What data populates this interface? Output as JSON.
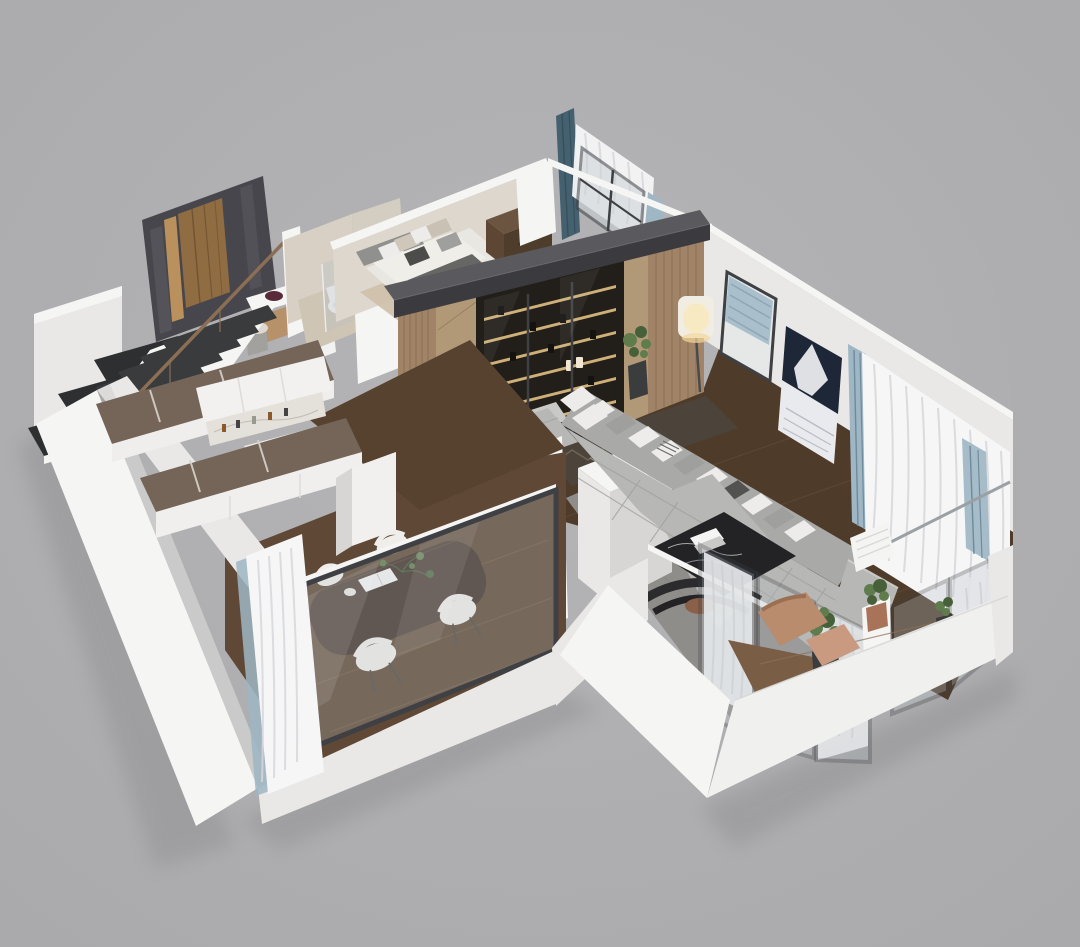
{
  "scene": {
    "label": "Isometric 3D cutaway render of a modern apartment floor plan on a gray background",
    "type": "architectural-visualization",
    "background": "#b5b5b7"
  },
  "rooms": [
    {
      "id": "entry-stairs",
      "label": "Entry hall with dark staircase, glossy wardrobe panel and bronze handrail"
    },
    {
      "id": "bathroom",
      "label": "Bathroom with toilet and glass shower partition"
    },
    {
      "id": "bedroom",
      "label": "Bedroom with upholstered bed, pillows and dark wood dresser"
    },
    {
      "id": "kitchen",
      "label": "U-shaped kitchen with smoked-oak counters, white fronts and marble island"
    },
    {
      "id": "dining-room",
      "label": "Dining room with dark wood table and four white chairs behind glazed wall"
    },
    {
      "id": "living-room",
      "label": "Living room with gray tufted corner sofa, marble coffee table and lit media wall"
    },
    {
      "id": "balcony-terrace",
      "label": "Glazed balcony terrace with plants, lounge chair and sheer curtains"
    }
  ],
  "palette": {
    "bg": "#b5b5b7",
    "bgEdge": "#aaaaac",
    "shadow": "#8e8e91",
    "wallWhite": "#f5f5f4",
    "wallLight": "#e9e8e6",
    "wallMid": "#d7d6d4",
    "wallShade": "#c7c6c4",
    "seam": "#dddcda",
    "beigeWall": "#d8d0c4",
    "beigeLite": "#ded7cd",
    "beigeFloor": "#cec0a9",
    "floorDark": "#4f3b2a",
    "floorStreak": "#66503a",
    "floorMid": "#5f4936",
    "floorMidStreak": "#7a624a",
    "balcWood": "#7a5d45",
    "balcStreak": "#8d7057",
    "counter": "#756559",
    "counterSeam": "#d8d3cb",
    "marble": "#e4e0da",
    "marbleVein": "#b9b5ae",
    "slabTop": "#5a5a5e",
    "slabFront": "#3b3b3f",
    "gloss": "#47464c",
    "glossHi": "#5d5c63",
    "doorWood": "#8f6c42",
    "doorGold": "#ba915c",
    "doorGrain": "#6b4e2e",
    "stairTread": "#3a3b3d",
    "stairDark": "#2e2f31",
    "rail": "#8c6e54",
    "slat": "#a18467",
    "slatDark": "#826a4e",
    "chevron": "#b19877",
    "shelfDark": "#221e19",
    "shelfGlow": "#ecca8a",
    "book1": "#d9d2c2",
    "book2": "#776753",
    "book3": "#3e3a34",
    "sofa": "#b7b7b5",
    "sofaDk": "#a9a9a7",
    "pilW": "#edecea",
    "pilG": "#9f9f9d",
    "pilD": "#525250",
    "rugGray": "#8f8d8a",
    "rugDark": "#4c443a",
    "rugZig": "#8a7a64",
    "tableBlack": "#232326",
    "vein": "#cdd0d3",
    "chairW": "#f0eeea",
    "chairLeg": "#4a4a48",
    "glassTint": "#b8c1c6",
    "frame": "#3e4043",
    "frameLt": "#9aa0a4",
    "curtW": "#f6f6f7",
    "curtShade": "#d6d7da",
    "curtB": "#9fb6c4",
    "curtBdk": "#6e8b9b",
    "teal": "#45616f",
    "blind": "#a9bfcb",
    "blindDk": "#8fa6b4",
    "artN": "#1d2737",
    "artW": "#e9eaed",
    "artStreak": "#b9bcc2",
    "green": "#5f7c4c",
    "greenDk": "#46603a",
    "pot": "#3a3c3e",
    "potClay": "#a9735a",
    "tan": "#b98c6e",
    "tanDk": "#9a6f52",
    "ottoman": "#c99a80",
    "lampGlow": "#f7e9c0",
    "lampShade": "#f2ede2",
    "lampWarm": "#f4d79a",
    "plum": "#582a3a",
    "stool": "#a3a19d",
    "toilet": "#f6f6f5"
  }
}
